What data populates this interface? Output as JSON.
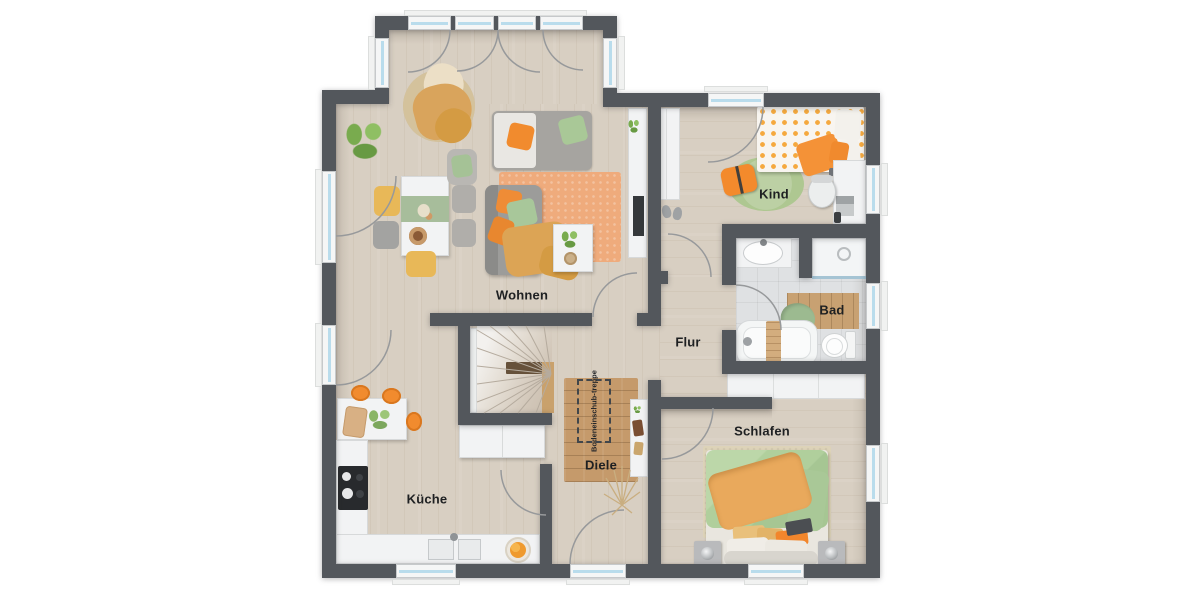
{
  "plan": {
    "type": "floor-plan",
    "rooms": [
      {
        "id": "wohnen",
        "label": "Wohnen"
      },
      {
        "id": "kueche",
        "label": "Küche"
      },
      {
        "id": "diele",
        "label": "Diele"
      },
      {
        "id": "flur",
        "label": "Flur"
      },
      {
        "id": "kind",
        "label": "Kind"
      },
      {
        "id": "bad",
        "label": "Bad"
      },
      {
        "id": "schlafen",
        "label": "Schlafen"
      }
    ],
    "stair_hatch": {
      "line1": "Bodeneinschub-",
      "line2": "treppe"
    },
    "colors": {
      "wall": "#53575c",
      "floor_wood": "#d8cfc2",
      "floor_tile": "#dfe1e3",
      "window_glass": "#b9dcec",
      "accent_orange": "#f18b2e",
      "accent_green": "#a9c897",
      "accent_mustard": "#dca455",
      "accent_salmon": "#efab7c",
      "rug_wood": "#c59a6b",
      "label_text": "#1e2022"
    }
  }
}
